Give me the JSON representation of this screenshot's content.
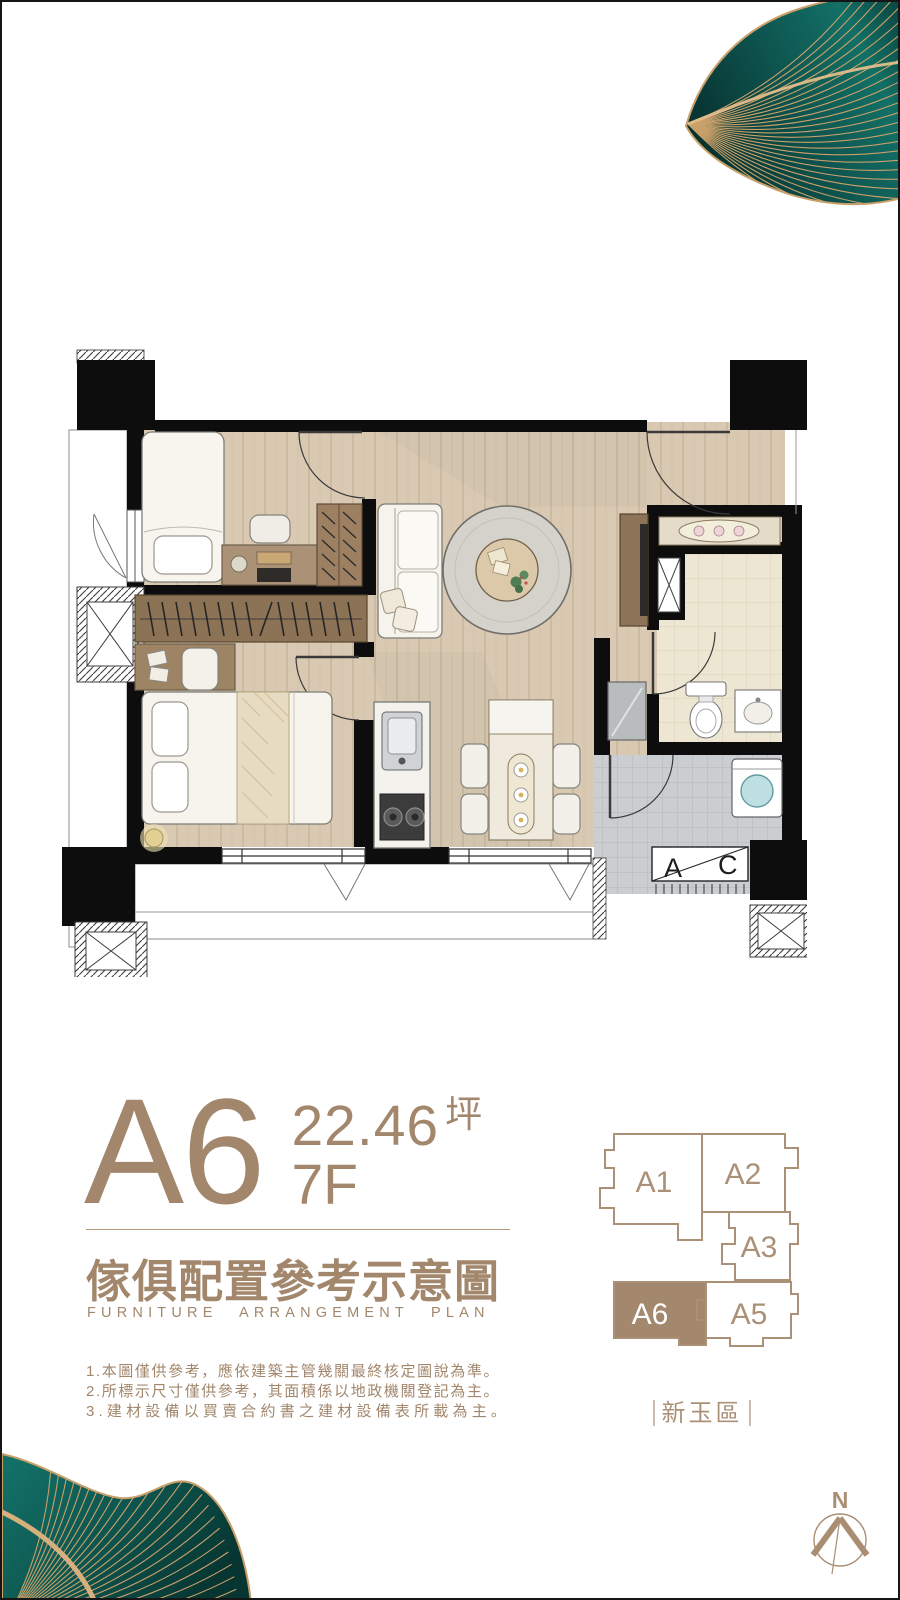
{
  "unit": {
    "code": "A6",
    "area": "22.46",
    "area_unit": "坪",
    "floor": "7F"
  },
  "title": {
    "zh": "傢俱配置參考示意圖",
    "en": "FURNITURE ARRANGEMENT PLAN"
  },
  "notes": [
    "1.本圖僅供參考，應依建築主管幾關最終核定圖說為準。",
    "2.所標示尺寸僅供參考，其面積係以地政機關登記為主。",
    "3.建材設備以買賣合約書之建材設備表所載為主。"
  ],
  "keyplan": {
    "district": "新玉區",
    "units": [
      {
        "label": "A1",
        "highlighted": false
      },
      {
        "label": "A2",
        "highlighted": false
      },
      {
        "label": "A3",
        "highlighted": false
      },
      {
        "label": "A6",
        "highlighted": true
      },
      {
        "label": "A5",
        "highlighted": false
      }
    ]
  },
  "floorplan": {
    "ac_label": {
      "left": "A",
      "right": "C"
    }
  },
  "compass": {
    "north_label": "N"
  },
  "colors": {
    "text_brown": "#a2876c",
    "keyplan_outline": "#ab9078",
    "keyplan_highlight": "#a3886e",
    "wall_black": "#0d0d0d",
    "leaf_teal_dark": "#0a423f",
    "leaf_teal": "#116058",
    "leaf_gold": "#c9a06a"
  }
}
